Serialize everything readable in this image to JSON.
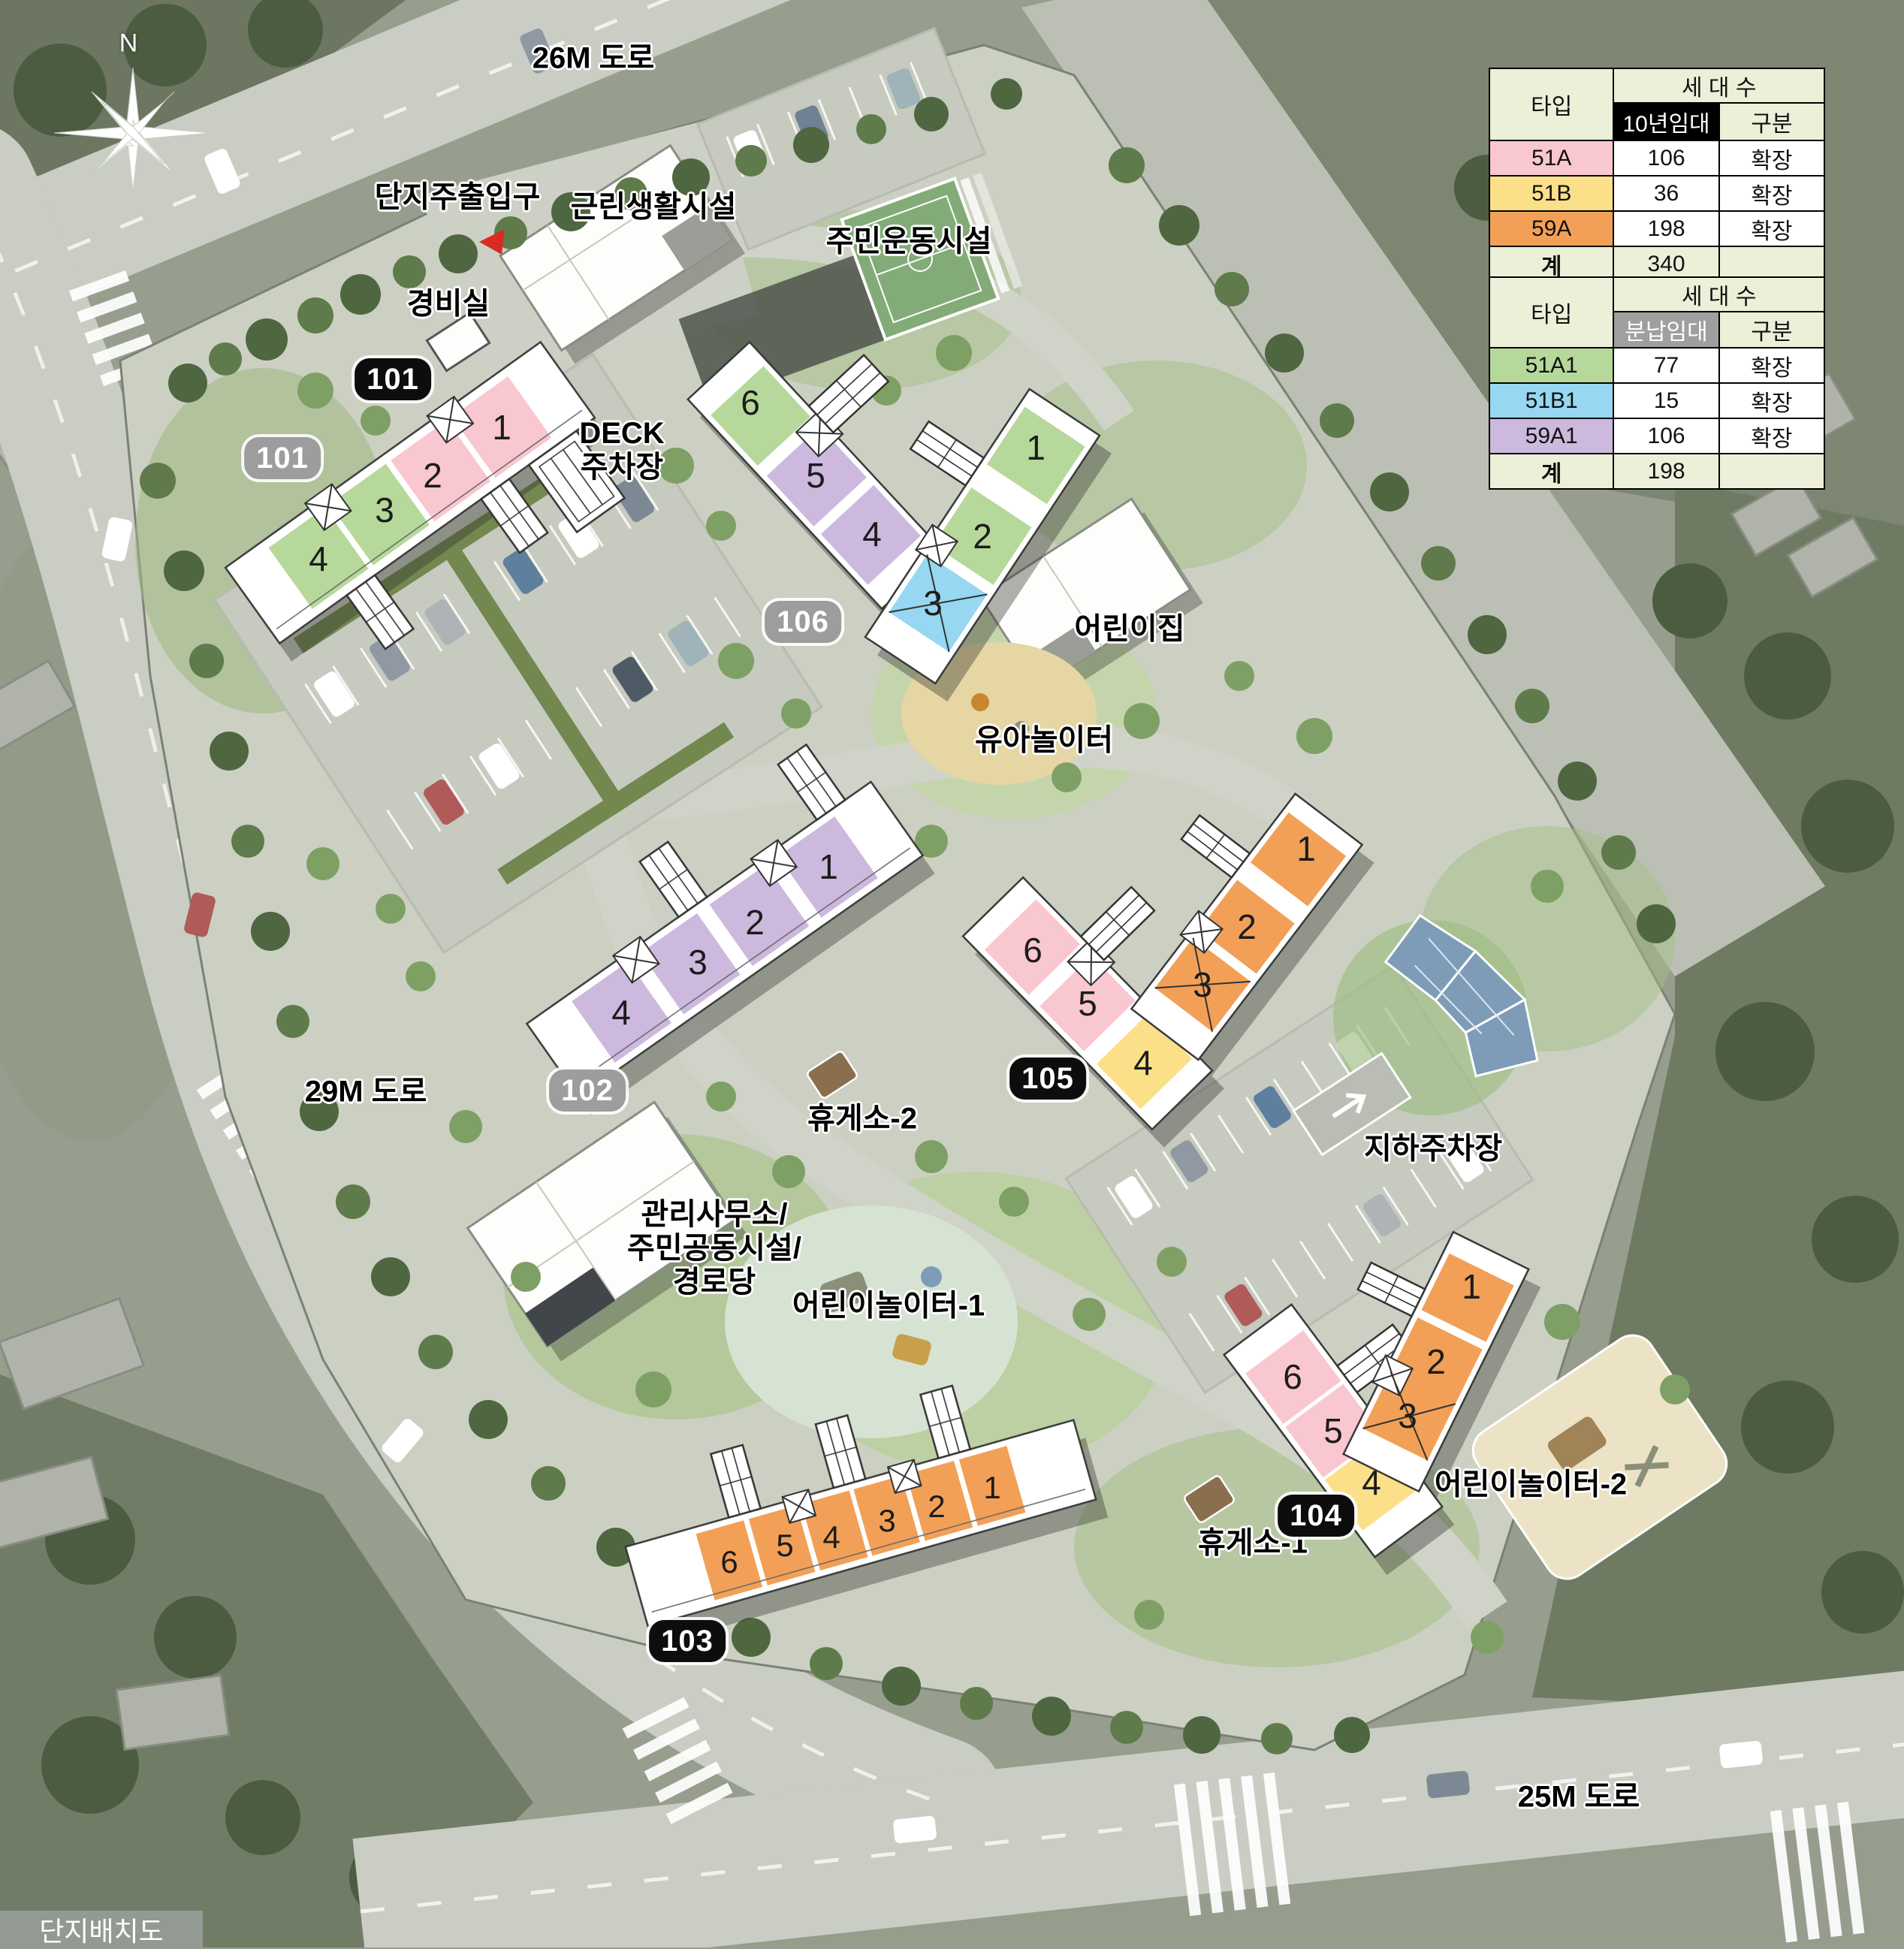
{
  "page_title": "단지배치도",
  "compass": {
    "north_label": "N"
  },
  "road_labels": {
    "top": "26M 도로",
    "left": "29M 도로",
    "bottom": "25M 도로"
  },
  "facility_labels": {
    "main_entrance": "단지주출입구",
    "neighborhood_facility": "근린생활시설",
    "sports_facility": "주민운동시설",
    "security_office": "경비실",
    "deck_parking": "DECK\n주차장",
    "daycare": "어린이집",
    "toddler_playground": "유아놀이터",
    "rest_area_2": "휴게소-2",
    "rest_area_1": "휴게소-1",
    "management_office": "관리사무소/\n주민공동시설/\n경로당",
    "children_playground_1": "어린이놀이터-1",
    "children_playground_2": "어린이놀이터-2",
    "underground_parking": "지하주차장"
  },
  "entrance_marker_color": "#d92b20",
  "unit_type_colors": {
    "51A": "#f9c7cf",
    "51B": "#fce089",
    "59A": "#f2a057",
    "51A1": "#b6d99b",
    "51B1": "#97d7f2",
    "59A1": "#cdb9de"
  },
  "buildings": [
    {
      "id": "101",
      "badges": [
        {
          "text": "101",
          "style": "black"
        },
        {
          "text": "101",
          "style": "gray"
        }
      ],
      "units": [
        {
          "no": "1",
          "type": "51A"
        },
        {
          "no": "2",
          "type": "51A"
        },
        {
          "no": "3",
          "type": "51A1"
        },
        {
          "no": "4",
          "type": "51A1"
        }
      ]
    },
    {
      "id": "102",
      "badges": [
        {
          "text": "102",
          "style": "gray"
        }
      ],
      "units": [
        {
          "no": "1",
          "type": "59A1"
        },
        {
          "no": "2",
          "type": "59A1"
        },
        {
          "no": "3",
          "type": "59A1"
        },
        {
          "no": "4",
          "type": "59A1"
        }
      ]
    },
    {
      "id": "103",
      "badges": [
        {
          "text": "103",
          "style": "black"
        }
      ],
      "units": [
        {
          "no": "1",
          "type": "59A"
        },
        {
          "no": "2",
          "type": "59A"
        },
        {
          "no": "3",
          "type": "59A"
        },
        {
          "no": "4",
          "type": "59A"
        },
        {
          "no": "5",
          "type": "59A"
        },
        {
          "no": "6",
          "type": "59A"
        }
      ]
    },
    {
      "id": "104",
      "badges": [
        {
          "text": "104",
          "style": "black"
        }
      ],
      "units": [
        {
          "no": "1",
          "type": "59A"
        },
        {
          "no": "2",
          "type": "59A"
        },
        {
          "no": "3",
          "type": "59A"
        },
        {
          "no": "4",
          "type": "51B"
        },
        {
          "no": "5",
          "type": "51A"
        },
        {
          "no": "6",
          "type": "51A"
        }
      ]
    },
    {
      "id": "105",
      "badges": [
        {
          "text": "105",
          "style": "black"
        }
      ],
      "units": [
        {
          "no": "1",
          "type": "59A"
        },
        {
          "no": "2",
          "type": "59A"
        },
        {
          "no": "3",
          "type": "59A"
        },
        {
          "no": "4",
          "type": "51B"
        },
        {
          "no": "5",
          "type": "51A"
        },
        {
          "no": "6",
          "type": "51A"
        }
      ]
    },
    {
      "id": "106",
      "badges": [
        {
          "text": "106",
          "style": "gray"
        }
      ],
      "units": [
        {
          "no": "1",
          "type": "51A1"
        },
        {
          "no": "2",
          "type": "51A1"
        },
        {
          "no": "3",
          "type": "51B1"
        },
        {
          "no": "4",
          "type": "59A1"
        },
        {
          "no": "5",
          "type": "59A1"
        },
        {
          "no": "6",
          "type": "51A1"
        }
      ]
    }
  ],
  "tables": [
    {
      "header_type": "타입",
      "header_units": "세 대 수",
      "header_sub": "10년임대",
      "header_div": "구분",
      "sub_style": "black",
      "rows": [
        {
          "type": "51A",
          "count": "106",
          "division": "확장",
          "color": "#f9c7cf"
        },
        {
          "type": "51B",
          "count": "36",
          "division": "확장",
          "color": "#fce089"
        },
        {
          "type": "59A",
          "count": "198",
          "division": "확장",
          "color": "#f2a057"
        }
      ],
      "total_label": "계",
      "total_count": "340",
      "total_division": ""
    },
    {
      "header_type": "타입",
      "header_units": "세 대 수",
      "header_sub": "분납임대",
      "header_div": "구분",
      "sub_style": "gray",
      "rows": [
        {
          "type": "51A1",
          "count": "77",
          "division": "확장",
          "color": "#b6d99b"
        },
        {
          "type": "51B1",
          "count": "15",
          "division": "확장",
          "color": "#97d7f2"
        },
        {
          "type": "59A1",
          "count": "106",
          "division": "확장",
          "color": "#cdb9de"
        }
      ],
      "total_label": "계",
      "total_count": "198",
      "total_division": ""
    }
  ]
}
